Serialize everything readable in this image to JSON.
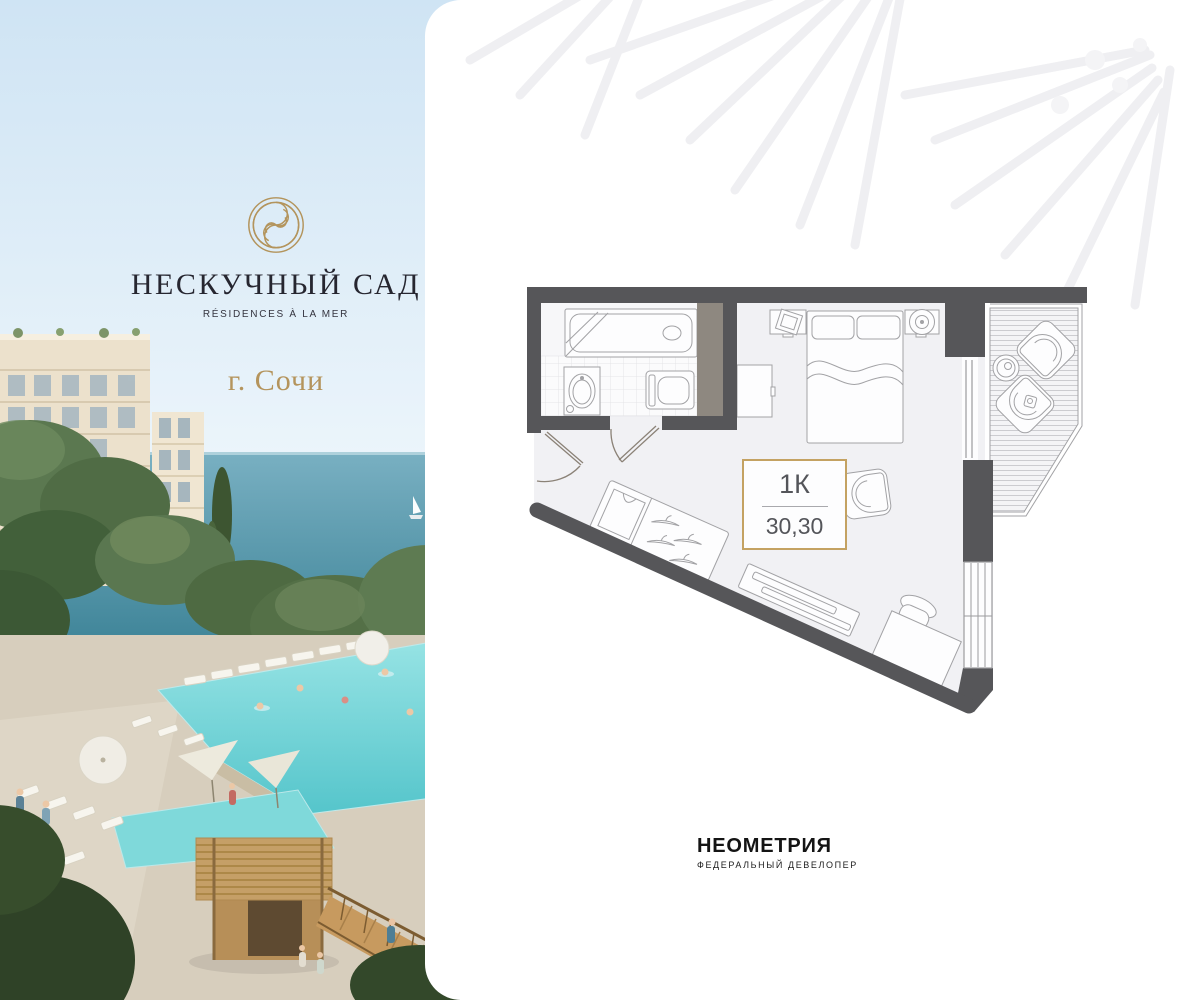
{
  "brand": {
    "emblem_icon": "spiral-monogram-icon",
    "project_name": "НЕСКУЧНЫЙ САД",
    "tagline": "RÉSIDENCES À LA MER",
    "city": "г. Сочи"
  },
  "floor_plan": {
    "type_label": "1К",
    "area_value": "30,30",
    "elements": [
      "bathtub",
      "sink",
      "toilet",
      "bathroom-door",
      "entrance-door",
      "shaft",
      "bed",
      "pillows",
      "nightstand-left",
      "nightstand-right",
      "table-lamp",
      "dresser",
      "armchair",
      "wardrobe-with-hangers",
      "tv-console",
      "desk",
      "desk-chair",
      "balcony-deck",
      "balcony-chairs",
      "balcony-table",
      "windows"
    ]
  },
  "developer": {
    "name": "НЕОМЕТРИЯ",
    "subtitle": "ФЕДЕРАЛЬНЫЙ ДЕВЕЛОПЕР"
  },
  "colors": {
    "wall": "#565659",
    "accent_gold": "#c4a262",
    "plan_floor": "#f1f1f4",
    "label_text": "#54555a",
    "sky": "#cfe4f4",
    "sea": "#4f93a8",
    "pool": "#6fd0d4",
    "watermark": "#efeff2"
  }
}
